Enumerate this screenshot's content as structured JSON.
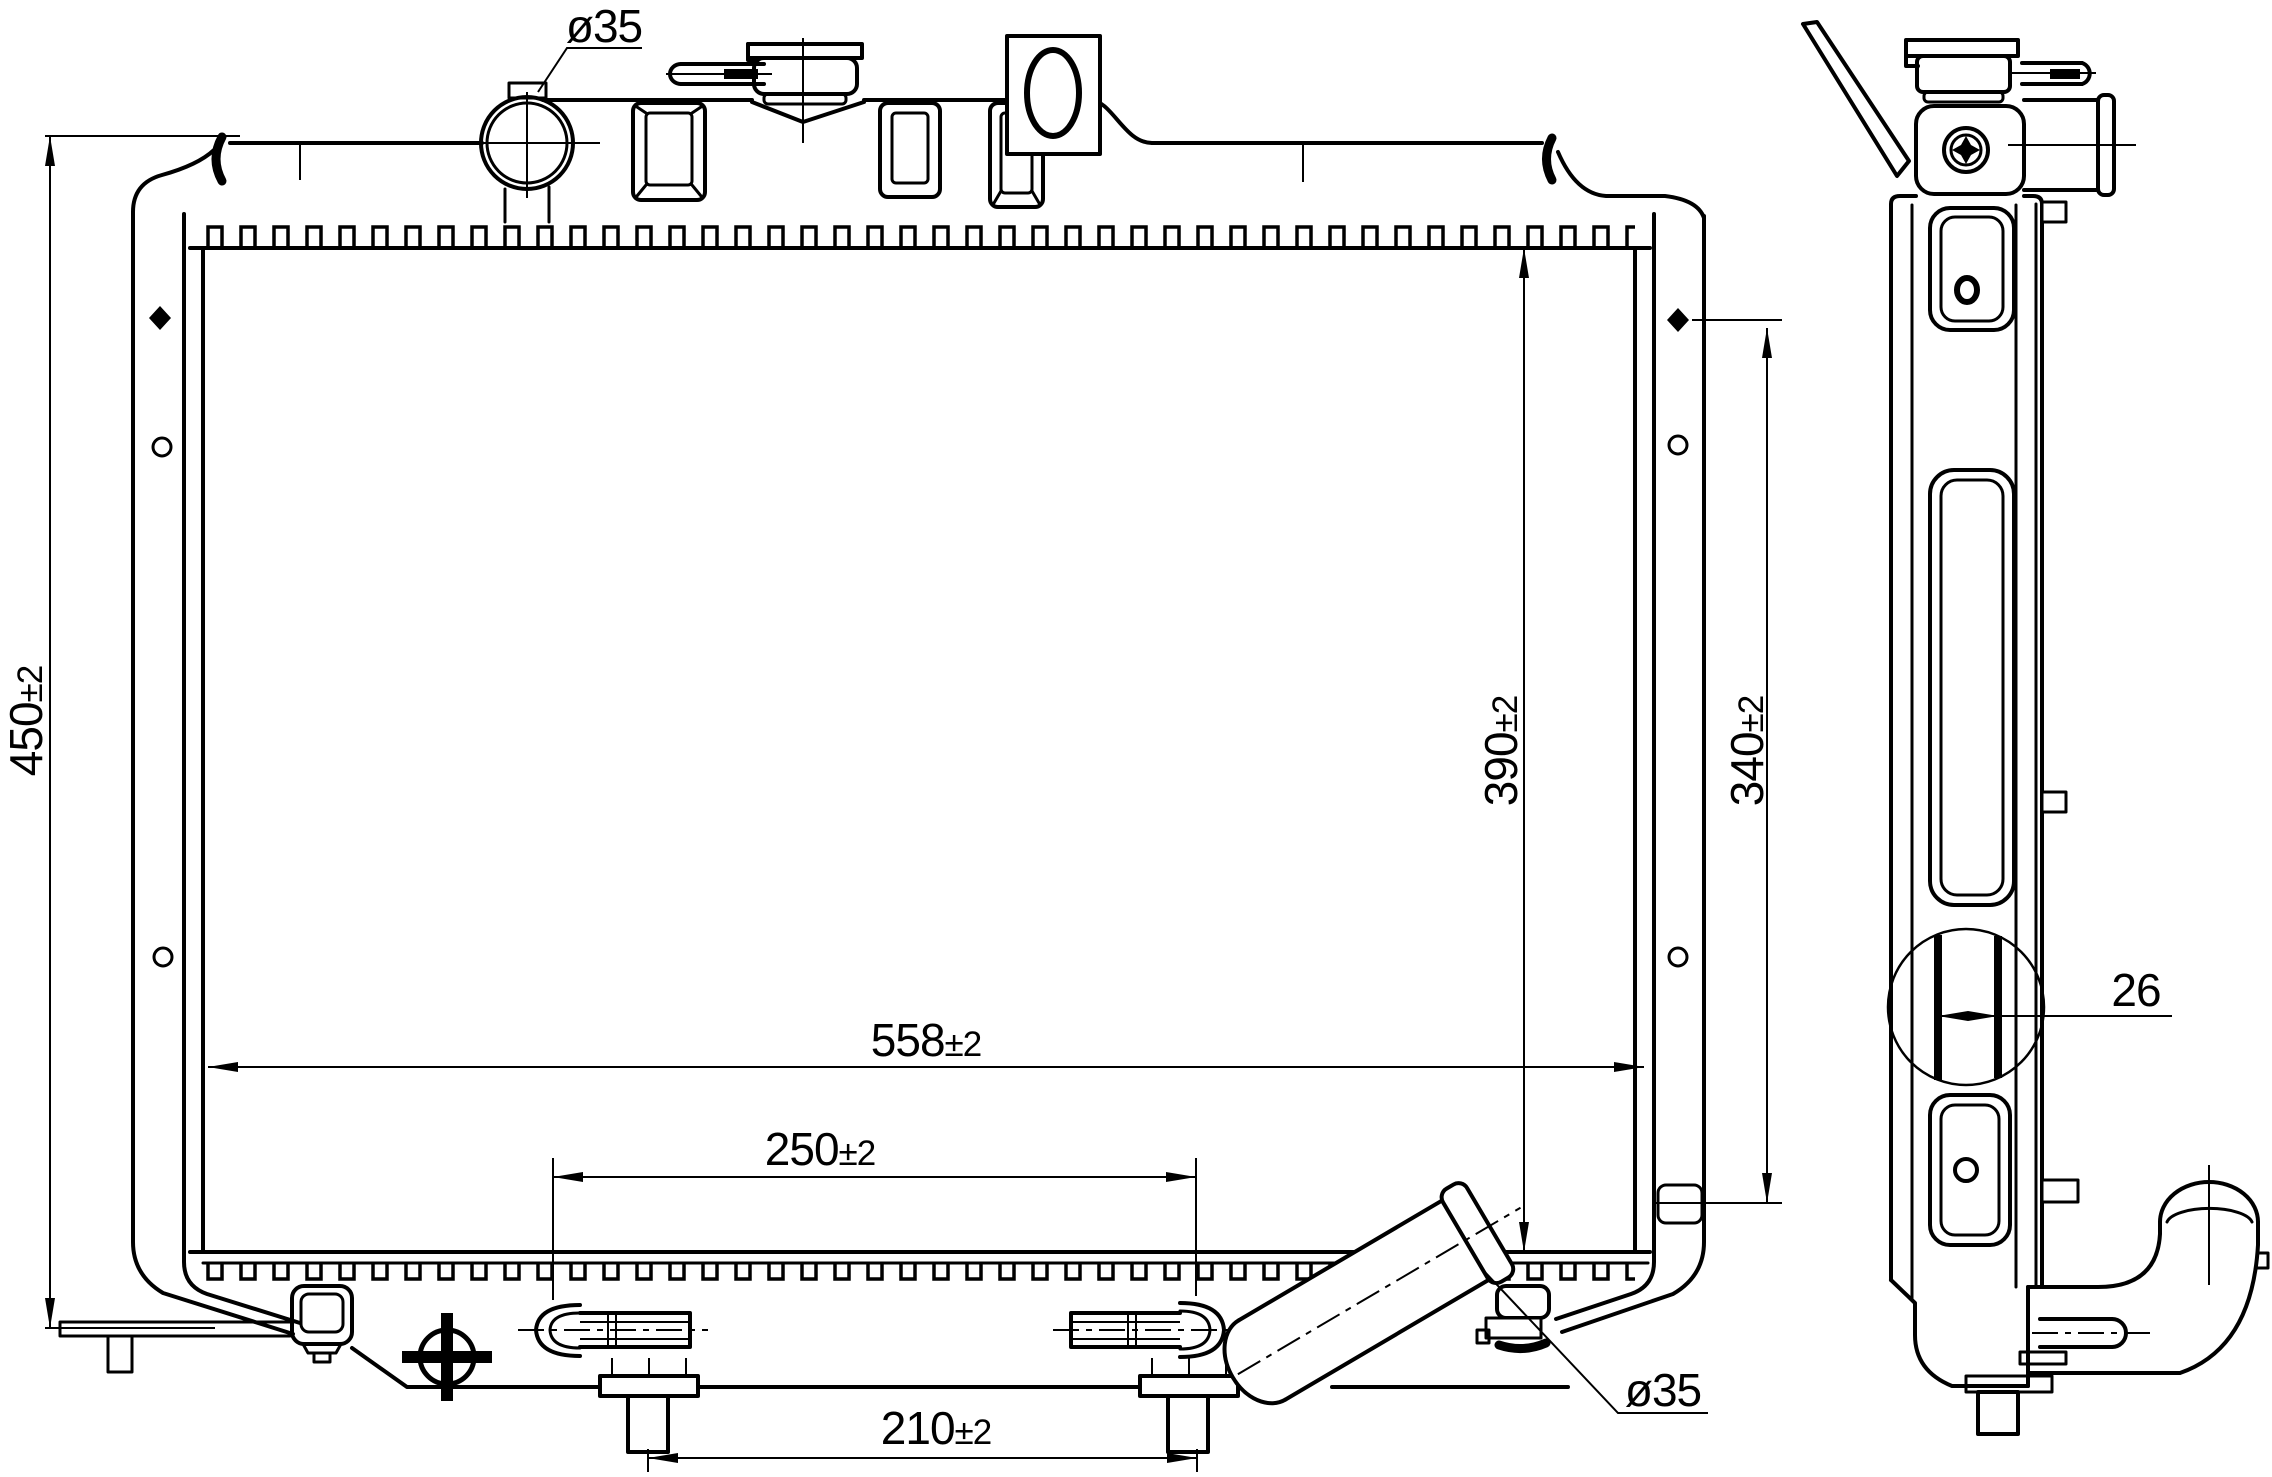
{
  "drawing": {
    "type": "radiator-technical-drawing",
    "colors": {
      "ink": "#000000",
      "paper": "#ffffff"
    },
    "dims": {
      "top_port_diameter": {
        "value": "ø35"
      },
      "overall_height": {
        "value": "450",
        "tol": "±2"
      },
      "core_height": {
        "value": "390",
        "tol": "±2"
      },
      "mount_span_vertical": {
        "value": "340",
        "tol": "±2"
      },
      "core_width": {
        "value": "558",
        "tol": "±2"
      },
      "fitting_span": {
        "value": "250",
        "tol": "±2"
      },
      "mount_pin_span": {
        "value": "210",
        "tol": "±2"
      },
      "core_thickness": {
        "value": "26"
      },
      "outlet_port_diameter": {
        "value": "ø35"
      }
    }
  }
}
